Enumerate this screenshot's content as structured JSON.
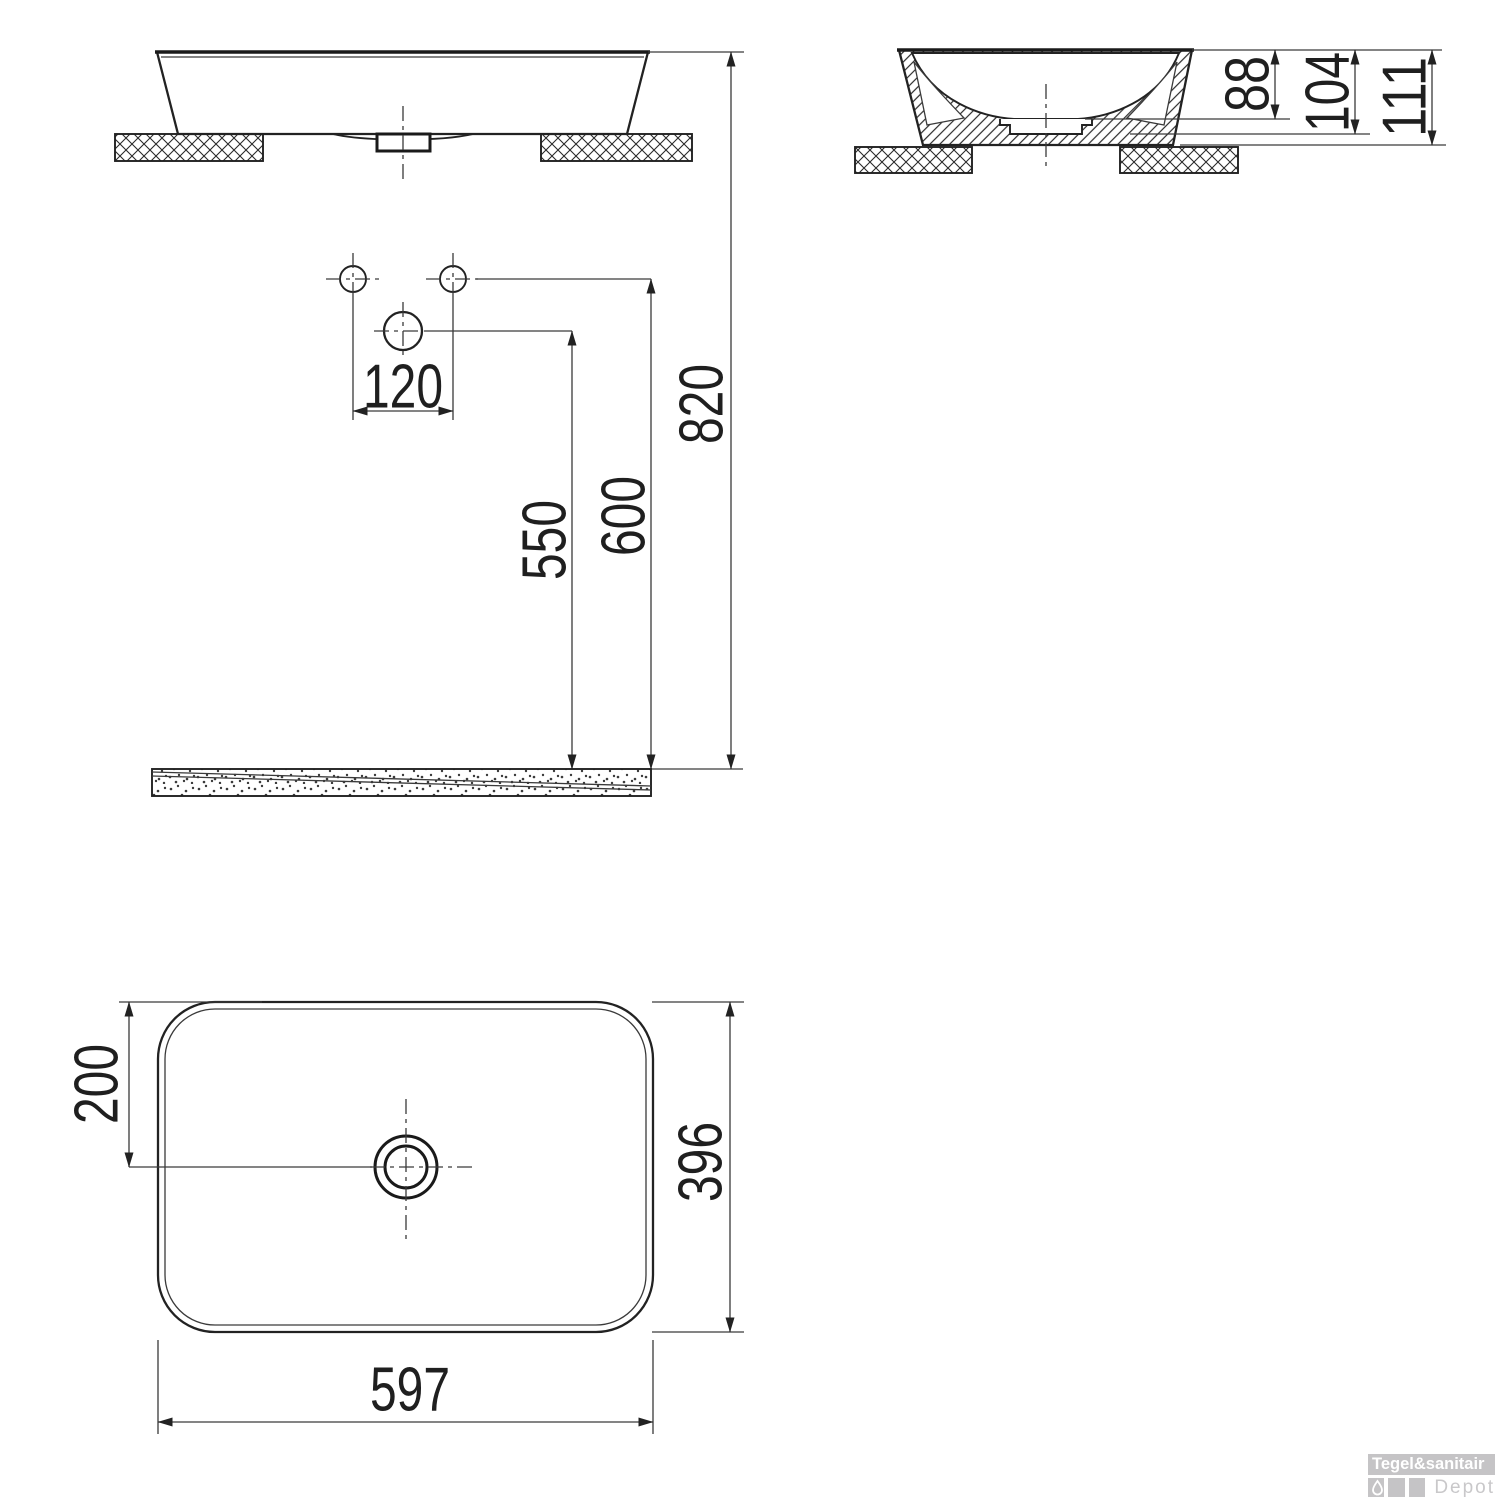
{
  "drawing": {
    "type": "technical-dimension-drawing",
    "subject": "countertop washbasin",
    "line_color": "#222222",
    "views": {
      "front_view": "front elevation on countertop",
      "side_view": "side cross-section on countertop",
      "plan_view": "top plan view with drain"
    },
    "dimensions": {
      "tap_hole_spacing": "120",
      "drain_line_height": "550",
      "tap_hole_height": "600",
      "rim_height": "820",
      "bowl_depth": "88",
      "ledge_height": "104",
      "overall_height": "111",
      "drain_offset": "200",
      "basin_depth_plan": "396",
      "basin_width_plan": "597"
    }
  },
  "logo": {
    "brand": "Tegel&sanitair",
    "sub_brand": "Depot",
    "tile_color": "#c5c4c6",
    "icon": "water-drop-icon"
  }
}
